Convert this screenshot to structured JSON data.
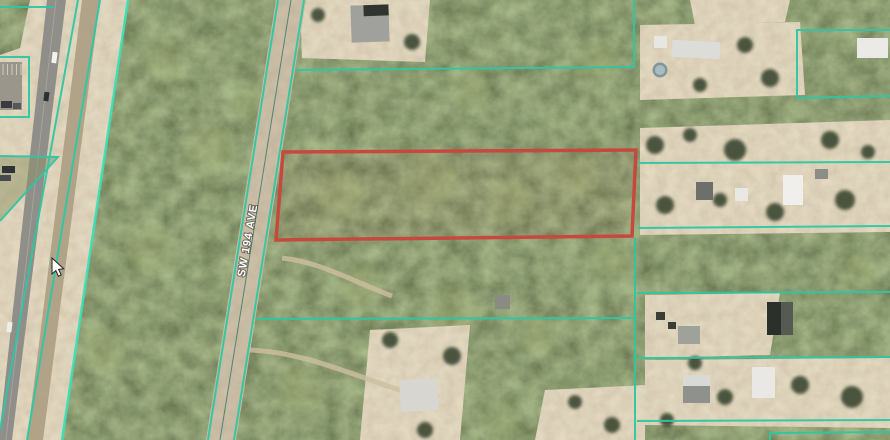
{
  "labels": {
    "road": "SW 194 AVE"
  },
  "colors": {
    "parcel_boundary_teal": "#2ec7a4",
    "bright_boundary_teal": "#3ce0b6",
    "highlight_parcel_red": "#c7493d",
    "woods_green": "#3f4a33",
    "clearing_tan": "#c3b493",
    "highway_gray": "#8f8e89",
    "dirt_road_tan": "#b1a287",
    "road_label_text": "#ffffff"
  },
  "icons": {
    "cursor_icon": "mouse-pointer"
  }
}
